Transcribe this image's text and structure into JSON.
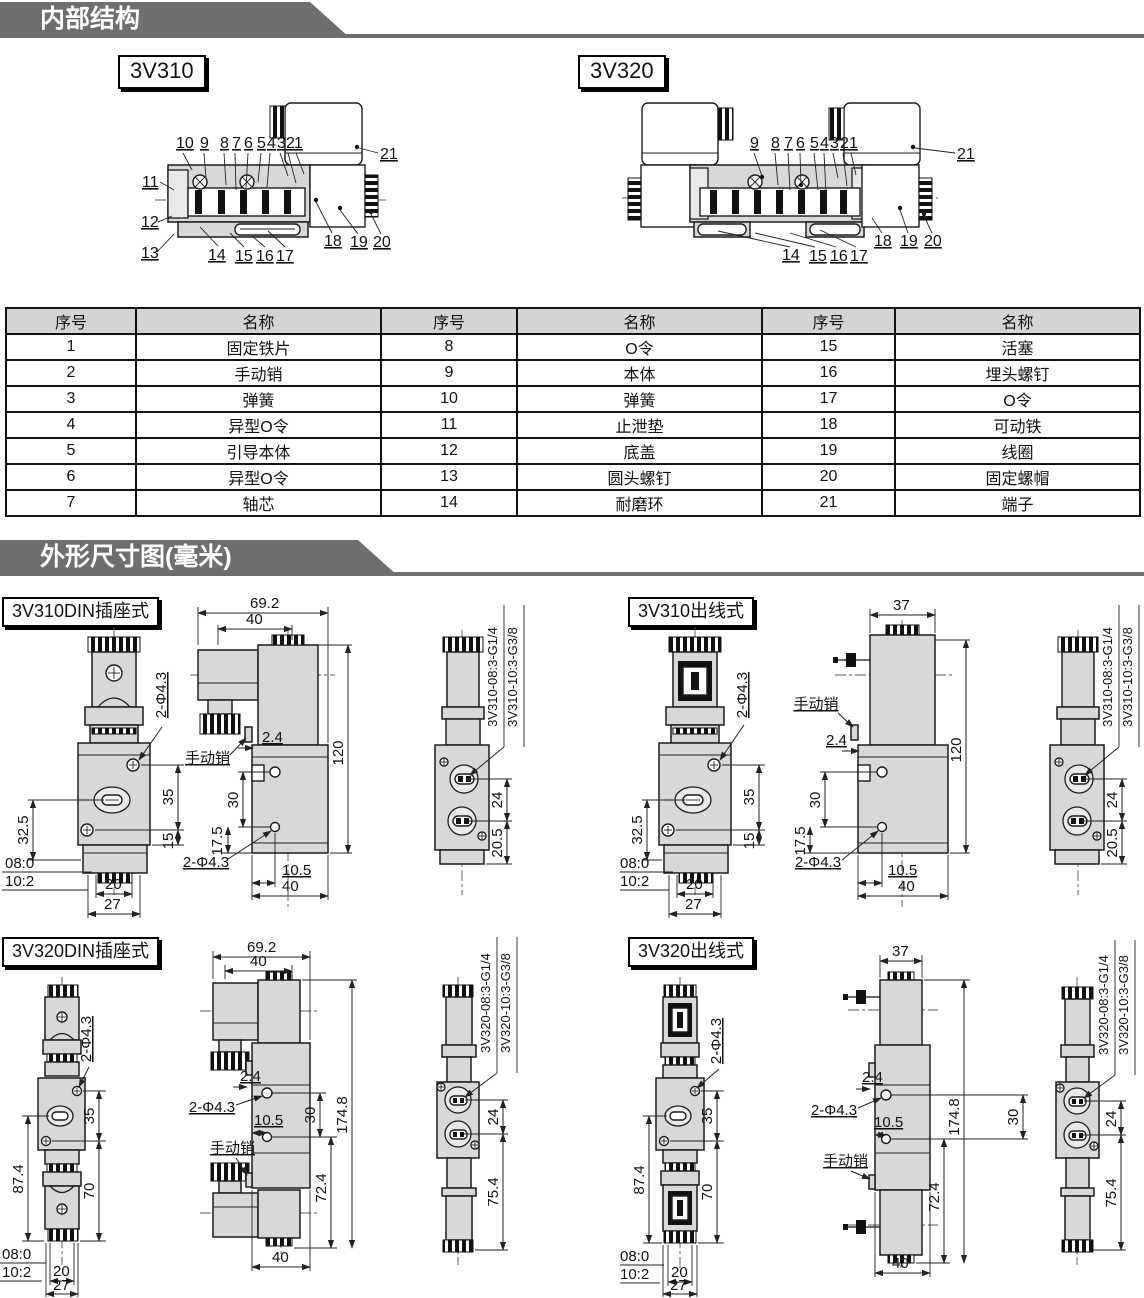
{
  "sections": {
    "internal": "内部结构",
    "dimensions": "外形尺寸图(毫米)"
  },
  "internal": {
    "v310": {
      "label": "3V310",
      "top": [
        "10",
        "9",
        "8",
        "7",
        "6",
        "5",
        "4",
        "3",
        "2",
        "1"
      ],
      "left": [
        "11",
        "12",
        "13"
      ],
      "bottom": [
        "14",
        "15",
        "16",
        "17"
      ],
      "right": [
        "18",
        "19",
        "20"
      ],
      "terminal": "21"
    },
    "v320": {
      "label": "3V320",
      "top": [
        "9",
        "8",
        "7",
        "6",
        "5",
        "4",
        "3",
        "2",
        "1"
      ],
      "bottom": [
        "14",
        "15",
        "16",
        "17"
      ],
      "right": [
        "18",
        "19",
        "20"
      ],
      "terminal": "21"
    }
  },
  "parts_table": {
    "headers": [
      "序号",
      "名称",
      "序号",
      "名称",
      "序号",
      "名称"
    ],
    "rows": [
      [
        "1",
        "固定铁片",
        "8",
        "O令",
        "15",
        "活塞"
      ],
      [
        "2",
        "手动销",
        "9",
        "本体",
        "16",
        "埋头螺钉"
      ],
      [
        "3",
        "弹簧",
        "10",
        "弹簧",
        "17",
        "O令"
      ],
      [
        "4",
        "异型O令",
        "11",
        "止泄垫",
        "18",
        "可动铁"
      ],
      [
        "5",
        "引导本体",
        "12",
        "底盖",
        "19",
        "线圈"
      ],
      [
        "6",
        "异型O令",
        "13",
        "圆头螺钉",
        "20",
        "固定螺帽"
      ],
      [
        "7",
        "轴芯",
        "14",
        "耐磨环",
        "21",
        "端子"
      ]
    ]
  },
  "panels": {
    "p1": {
      "title": "3V310DIN插座式",
      "front": {
        "hole": "2-Φ4.3",
        "d35": "35",
        "d15": "15",
        "d32_5": "32.5",
        "p08": "08:0",
        "p10": "10:2",
        "d20": "20",
        "d27": "27"
      },
      "side": {
        "w1": "69.2",
        "w2": "40",
        "h": "120",
        "gap": "2.4",
        "pin": "手动销",
        "d30": "30",
        "d17_5": "17.5",
        "hole": "2-Φ4.3",
        "d10_5": "10.5",
        "w3": "40"
      },
      "end": {
        "m1": "3V310-08:3-G1/4",
        "m2": "3V310-10:3-G3/8",
        "d24": "24",
        "d20_5": "20.5"
      }
    },
    "p2": {
      "title": "3V310出线式",
      "front": {
        "hole": "2-Φ4.3",
        "d35": "35",
        "d15": "15",
        "d32_5": "32.5",
        "p08": "08:0",
        "p10": "10:2",
        "d20": "20",
        "d27": "27"
      },
      "side": {
        "w1": "37",
        "h": "120",
        "gap": "2.4",
        "pin": "手动销",
        "d30": "30",
        "d17_5": "17.5",
        "hole": "2-Φ4.3",
        "d10_5": "10.5",
        "w3": "40"
      },
      "end": {
        "m1": "3V310-08:3-G1/4",
        "m2": "3V310-10:3-G3/8",
        "d24": "24",
        "d20_5": "20.5"
      }
    },
    "p3": {
      "title": "3V320DIN插座式",
      "front": {
        "hole": "2-Φ4.3",
        "d35": "35",
        "d70": "70",
        "d87_4": "87.4",
        "p08": "08:0",
        "p10": "10:2",
        "d20": "20",
        "d27": "27"
      },
      "side": {
        "w1": "69.2",
        "w2": "40",
        "h": "174.8",
        "gap": "2.4",
        "pin": "手动销",
        "d30": "30",
        "d72_4": "72.4",
        "hole": "2-Φ4.3",
        "d10_5": "10.5",
        "w3": "40"
      },
      "end": {
        "m1": "3V320-08:3-G1/4",
        "m2": "3V320-10:3-G3/8",
        "d24": "24",
        "d75_4": "75.4"
      }
    },
    "p4": {
      "title": "3V320出线式",
      "front": {
        "hole": "2-Φ4.3",
        "d35": "35",
        "d70": "70",
        "d87_4": "87.4",
        "p08": "08:0",
        "p10": "10:2",
        "d20": "20",
        "d27": "27"
      },
      "side": {
        "w1": "37",
        "h": "174.8",
        "gap": "2.4",
        "pin": "手动销",
        "d30": "30",
        "d72_4": "72.4",
        "hole": "2-Φ4.3",
        "d10_5": "10.5",
        "w3": "40"
      },
      "end": {
        "m1": "3V320-08:3-G1/4",
        "m2": "3V320-10:3-G3/8",
        "d24": "24",
        "d75_4": "75.4"
      }
    }
  }
}
